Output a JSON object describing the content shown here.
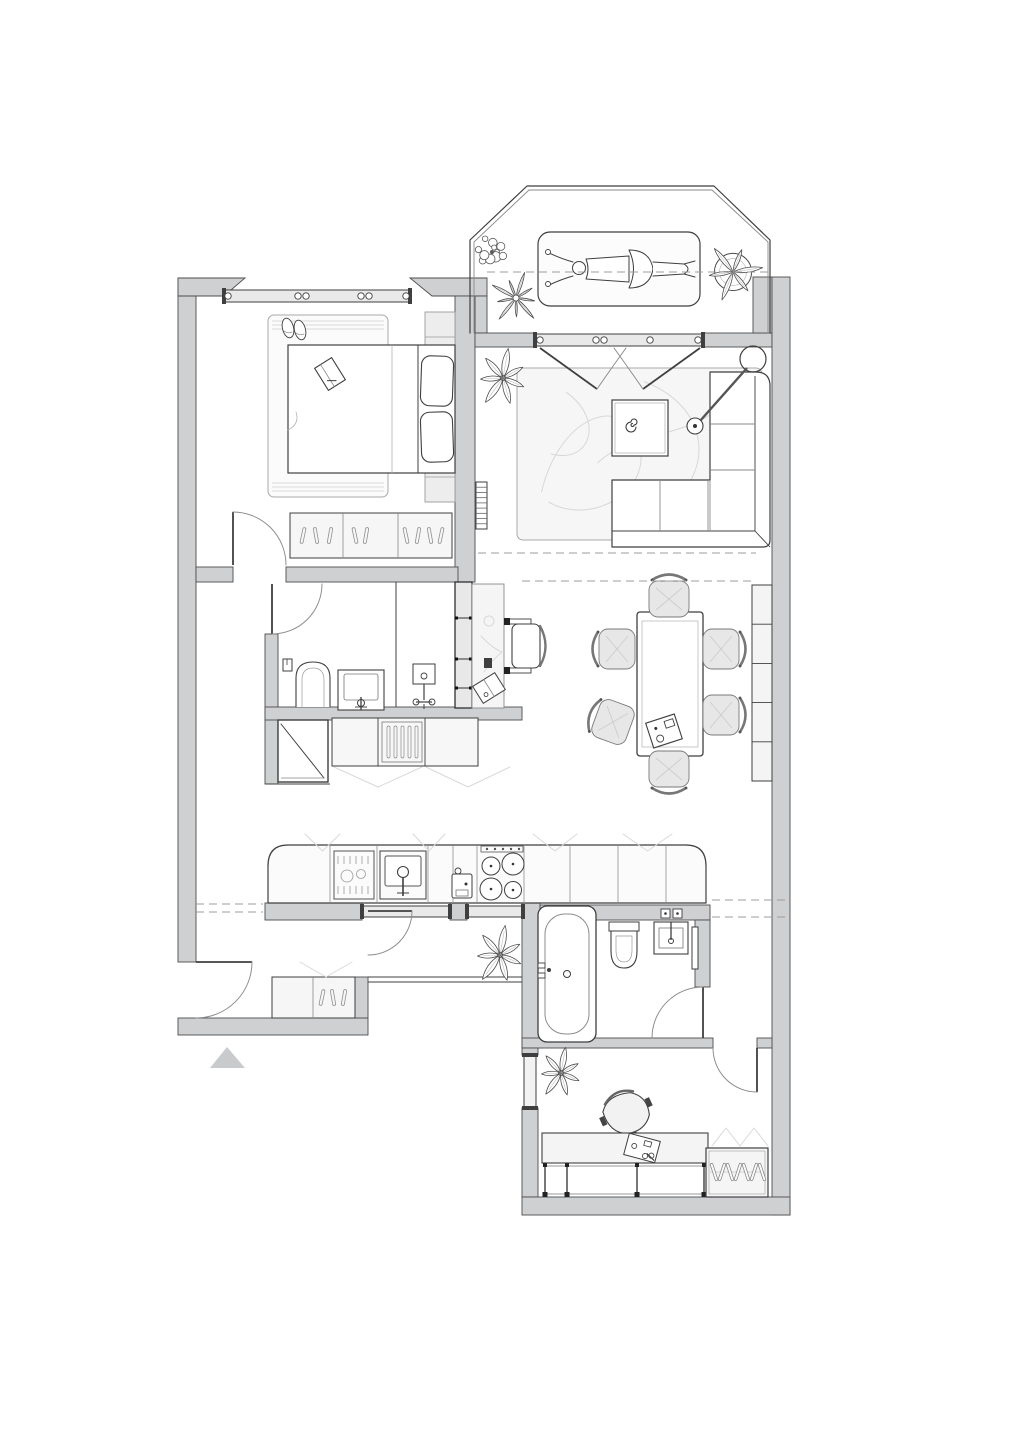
{
  "meta": {
    "title": "Apartment floor plan, top view, furnished"
  },
  "canvas": {
    "width": 1018,
    "height": 1440,
    "background": "#ffffff"
  },
  "palette": {
    "wall_fill": "#cfd0d2",
    "wall_stroke": "#4d4d4d",
    "line": "#3f3f3f",
    "line_mid": "#8a8a8a",
    "ghost": "#d9d9d9",
    "dash": "#9c9c9c",
    "light": "#f3f3f4",
    "chair_fill": "#e7e7e8",
    "marker_fill": "#c9cacc",
    "rug_line": "#d8d8d8"
  },
  "rooms": [
    {
      "name": "balcony",
      "items": [
        "sun-lounger",
        "plants",
        "railing"
      ]
    },
    {
      "name": "bedroom",
      "items": [
        "double-bed",
        "rug",
        "slippers",
        "book",
        "headboard-panel",
        "sideboard",
        "window"
      ]
    },
    {
      "name": "living-room",
      "items": [
        "rug",
        "coffee-table",
        "corner-sofa",
        "arc-floor-lamp",
        "radiator",
        "plant",
        "balcony-doors"
      ]
    },
    {
      "name": "dining-area",
      "items": [
        "dining-table",
        "six-chairs",
        "shelf-unit",
        "serving-tray"
      ]
    },
    {
      "name": "bathroom",
      "items": [
        "toilet",
        "washbasin",
        "shower-mixer",
        "partition"
      ]
    },
    {
      "name": "hall-closet",
      "items": [
        "mirror-panel",
        "drawer-unit",
        "folding-doors"
      ]
    },
    {
      "name": "workspace-nook",
      "items": [
        "desk",
        "chair",
        "notebook",
        "storage-wall"
      ]
    },
    {
      "name": "kitchen",
      "items": [
        "counter",
        "dishwasher",
        "sink",
        "cooktop",
        "coffee-machine",
        "plant",
        "glazed-partition-door"
      ]
    },
    {
      "name": "hallway",
      "items": [
        "shoe-cabinet",
        "entry-door",
        "entrance-marker"
      ]
    },
    {
      "name": "bathroom-2",
      "items": [
        "bathtub",
        "toilet",
        "washbasin",
        "towel-rail"
      ]
    },
    {
      "name": "office",
      "items": [
        "desk",
        "office-chair",
        "wardrobe",
        "plant",
        "window"
      ]
    }
  ],
  "plan": {
    "railing": {
      "name": "balcony-railing",
      "outer": "M 470,333 L 470,240 L 527,186 L 714,186 L 770,240 L 770,333",
      "inner": "M 474,333 L 474,242 L 529,190 L 712,190 L 768,242 L 768,333"
    },
    "walls": [
      {
        "name": "outer-left-wall",
        "rect": [
          178,
          278,
          18,
          684
        ]
      },
      {
        "name": "hall-south-wall",
        "rect": [
          178,
          1018,
          190,
          17
        ]
      },
      {
        "name": "bedroom-north-wall-left",
        "poly": [
          [
            178,
            278
          ],
          [
            245,
            278
          ],
          [
            224,
            296
          ],
          [
            178,
            296
          ]
        ]
      },
      {
        "name": "bedroom-north-wall-right",
        "poly": [
          [
            410,
            278
          ],
          [
            487,
            278
          ],
          [
            487,
            296
          ],
          [
            432,
            296
          ]
        ]
      },
      {
        "name": "balcony-west-jamb",
        "rect": [
          475,
          296,
          12,
          37
        ]
      },
      {
        "name": "bedroom-living-divider-wall",
        "rect": [
          455,
          296,
          20,
          286
        ]
      },
      {
        "name": "bedroom-south-wall-left",
        "rect": [
          196,
          567,
          37,
          15
        ]
      },
      {
        "name": "bedroom-south-wall-right",
        "rect": [
          286,
          567,
          172,
          15
        ]
      },
      {
        "name": "bathroom-west-wall",
        "rect": [
          265,
          634,
          13,
          78
        ]
      },
      {
        "name": "closet-west-wall",
        "rect": [
          265,
          712,
          13,
          72
        ]
      },
      {
        "name": "bathroom-south-wall",
        "rect": [
          265,
          707,
          257,
          13
        ]
      },
      {
        "name": "balcony-wall-left",
        "rect": [
          475,
          333,
          60,
          14
        ]
      },
      {
        "name": "balcony-wall-right",
        "rect": [
          703,
          333,
          69,
          14
        ]
      },
      {
        "name": "balcony-east-wall",
        "rect": [
          753,
          277,
          19,
          56
        ]
      },
      {
        "name": "outer-right-wall",
        "rect": [
          772,
          277,
          18,
          938
        ]
      },
      {
        "name": "kitchen-back-wall-a",
        "rect": [
          265,
          903,
          97,
          17
        ]
      },
      {
        "name": "kitchen-back-wall-b",
        "rect": [
          450,
          903,
          17,
          17
        ]
      },
      {
        "name": "bathroom2-west-wall",
        "rect": [
          522,
          903,
          18,
          145
        ]
      },
      {
        "name": "bathroom2-north-wall",
        "rect": [
          540,
          905,
          170,
          15
        ]
      },
      {
        "name": "bathroom2-east-wall",
        "rect": [
          695,
          920,
          15,
          67
        ]
      },
      {
        "name": "office-north-wall",
        "rect": [
          522,
          1038,
          191,
          10
        ]
      },
      {
        "name": "office-north-wall-stub",
        "rect": [
          757,
          1038,
          15,
          10
        ]
      },
      {
        "name": "office-west-wall-a",
        "rect": [
          522,
          1048,
          16,
          7
        ]
      },
      {
        "name": "office-west-wall-b",
        "rect": [
          522,
          1108,
          16,
          89
        ]
      },
      {
        "name": "office-south-wall",
        "rect": [
          522,
          1197,
          268,
          18
        ]
      },
      {
        "name": "hall-parapet-post",
        "rect": [
          355,
          977,
          13,
          41
        ]
      }
    ],
    "windows": [
      {
        "name": "bedroom-window",
        "band": [
          224,
          290,
          186,
          12
        ],
        "mullions": [
          228,
          298,
          306,
          361,
          369,
          406
        ]
      },
      {
        "name": "balcony-door-glazing",
        "band": [
          535,
          334,
          168,
          12
        ],
        "mullions": [
          540,
          596,
          604,
          650,
          698
        ]
      },
      {
        "name": "kitchen-window-a",
        "band": [
          362,
          906,
          88,
          11
        ],
        "mullions": []
      },
      {
        "name": "kitchen-window-b",
        "band": [
          467,
          906,
          56,
          11
        ],
        "mullions": []
      },
      {
        "name": "office-window",
        "vband": [
          524,
          1055,
          12,
          53
        ]
      }
    ],
    "thin_lines": [
      {
        "name": "hall-parapet-a",
        "line": [
          368,
          977,
          522,
          977
        ]
      },
      {
        "name": "hall-parapet-b",
        "line": [
          368,
          982,
          522,
          982
        ]
      },
      {
        "name": "bathroom-partition",
        "line": [
          396,
          582,
          396,
          707
        ]
      },
      {
        "name": "closet-base",
        "line": [
          265,
          784,
          330,
          784
        ]
      }
    ],
    "doors": [
      {
        "name": "bedroom-door",
        "leaf": [
          233,
          565,
          233,
          512
        ],
        "arc": "M 233,512 A 53 53 0 0 1 286,565"
      },
      {
        "name": "bathroom-door",
        "leaf": [
          272,
          584,
          272,
          634
        ],
        "arc": "M 272,634 A 50 50 0 0 0 322,584"
      },
      {
        "name": "entry-door",
        "leaf": [
          196,
          962,
          252,
          962
        ],
        "arc": "M 252,962 A 56 56 0 0 1 196,1018"
      },
      {
        "name": "kitchen-glass-door",
        "leaf": [
          368,
          911,
          412,
          911
        ],
        "arc": "M 412,911 A 44 44 0 0 1 368,955"
      },
      {
        "name": "bathroom2-door",
        "leaf": [
          703,
          987,
          703,
          1038
        ],
        "arc": "M 703,987 A 51 51 0 0 0 652,1038"
      },
      {
        "name": "office-door",
        "leaf": [
          757,
          1048,
          757,
          1092
        ],
        "arc": "M 713,1048 A 44 44 0 0 0 757,1092"
      },
      {
        "name": "balcony-door-left",
        "leaf": [
          540,
          348,
          597,
          389
        ],
        "arc": "M 597,389 Q 613,366 626,348"
      },
      {
        "name": "balcony-door-right",
        "leaf": [
          700,
          348,
          643,
          389
        ],
        "arc": "M 643,389 Q 627,366 614,348"
      }
    ],
    "dashes": [
      {
        "name": "roof-line-balcony",
        "line": [
          487,
          272,
          768,
          272
        ]
      },
      {
        "name": "roof-line-living",
        "line": [
          478,
          553,
          756,
          553
        ]
      },
      {
        "name": "roof-line-dining",
        "line": [
          522,
          581,
          756,
          581
        ]
      },
      {
        "name": "roof-line-hall-a",
        "line": [
          196,
          904,
          263,
          904
        ]
      },
      {
        "name": "roof-line-hall-b",
        "line": [
          196,
          912,
          263,
          912
        ]
      },
      {
        "name": "roof-line-east-a",
        "line": [
          712,
          900,
          790,
          900
        ]
      },
      {
        "name": "roof-line-east-b",
        "line": [
          712,
          917,
          790,
          917
        ]
      }
    ],
    "furniture": [
      {
        "name": "living-rug",
        "type": "rug",
        "rect": [
          517,
          368,
          245,
          172
        ],
        "swirls": true
      },
      {
        "name": "bedroom-rug",
        "type": "rug",
        "rect": [
          268,
          315,
          120,
          182
        ],
        "fringe": true
      },
      {
        "name": "headboard-panel",
        "type": "panel",
        "rect": [
          425,
          312,
          30,
          190
        ],
        "divs": [
          337,
          477
        ]
      },
      {
        "name": "double-bed",
        "type": "bed",
        "rect": [
          288,
          345,
          167,
          128
        ]
      },
      {
        "name": "slippers",
        "type": "slippers",
        "at": [
          292,
          328
        ]
      },
      {
        "name": "book-on-bed",
        "type": "book",
        "at": [
          330,
          374
        ],
        "rot": -32
      },
      {
        "name": "bedroom-sideboard",
        "type": "sideboard",
        "rect": [
          290,
          513,
          162,
          45
        ],
        "divs": [
          343,
          398
        ],
        "ticks": [
          [
            303,
            12
          ],
          [
            316,
            -10
          ],
          [
            330,
            10
          ],
          [
            355,
            -12
          ],
          [
            366,
            10
          ],
          [
            406,
            -12
          ],
          [
            418,
            10
          ],
          [
            430,
            -10
          ],
          [
            441,
            12
          ]
        ]
      },
      {
        "name": "corner-sofa",
        "type": "sofa",
        "rect": [
          612,
          372,
          158,
          175
        ]
      },
      {
        "name": "coffee-table",
        "type": "coffee-table",
        "rect": [
          612,
          400,
          56,
          56
        ]
      },
      {
        "name": "arc-lamp",
        "type": "arc-lamp",
        "base": [
          753,
          359
        ],
        "head": [
          695,
          426
        ]
      },
      {
        "name": "living-radiator",
        "type": "radiator",
        "rect": [
          476,
          482,
          11,
          47
        ]
      },
      {
        "name": "dining-table",
        "type": "dining-table",
        "rect": [
          637,
          612,
          66,
          144
        ]
      },
      {
        "name": "dining-chair-north",
        "type": "chair",
        "at": [
          669,
          599
        ],
        "rot": 0
      },
      {
        "name": "dining-chair-west-1",
        "type": "chair",
        "at": [
          617,
          649
        ],
        "rot": -90
      },
      {
        "name": "dining-chair-east-1",
        "type": "chair",
        "at": [
          721,
          649
        ],
        "rot": 90
      },
      {
        "name": "dining-chair-west-2",
        "type": "chair",
        "at": [
          613,
          722
        ],
        "rot": -70
      },
      {
        "name": "dining-chair-east-2",
        "type": "chair",
        "at": [
          721,
          715
        ],
        "rot": 90
      },
      {
        "name": "dining-chair-south",
        "type": "chair",
        "at": [
          669,
          769
        ],
        "rot": 180
      },
      {
        "name": "dining-shelf",
        "type": "shelf",
        "rect": [
          752,
          585,
          20,
          196
        ],
        "cells": 5
      },
      {
        "name": "nook-storage-wall",
        "type": "storage-band",
        "rect": [
          455,
          582,
          17,
          126
        ],
        "divs": [
          618,
          659,
          688
        ]
      },
      {
        "name": "nook-desk",
        "type": "desk-v",
        "rect": [
          472,
          584,
          32,
          124
        ]
      },
      {
        "name": "nook-chair",
        "type": "chair-side",
        "at": [
          526,
          646
        ]
      },
      {
        "name": "toilet",
        "type": "toilet-up",
        "at": [
          296,
          660
        ]
      },
      {
        "name": "washbasin",
        "type": "sink-up",
        "rect": [
          338,
          670,
          46,
          40
        ]
      },
      {
        "name": "shower-mixer",
        "type": "mixer",
        "at": [
          413,
          664
        ]
      },
      {
        "name": "closet-mirror",
        "type": "mirror",
        "rect": [
          278,
          720,
          50,
          62
        ]
      },
      {
        "name": "closet-cabinets",
        "type": "closet-row",
        "rect": [
          332,
          718,
          146,
          48
        ],
        "divs": [
          378,
          425
        ]
      },
      {
        "name": "kitchen-counter",
        "type": "kitchen",
        "rect": [
          268,
          845,
          438,
          58
        ]
      },
      {
        "name": "shoe-cabinet",
        "type": "sideboard",
        "rect": [
          272,
          977,
          83,
          41
        ],
        "divs": [
          313
        ],
        "ticks": [
          [
            322,
            12
          ],
          [
            333,
            -10
          ],
          [
            344,
            10
          ]
        ],
        "vs": true
      },
      {
        "name": "entrance-marker",
        "type": "marker",
        "poly": [
          [
            210,
            1068
          ],
          [
            245,
            1068
          ],
          [
            227,
            1047
          ]
        ]
      },
      {
        "name": "bathtub",
        "type": "bathtub",
        "rect": [
          538,
          906,
          58,
          136
        ]
      },
      {
        "name": "toilet-2",
        "type": "toilet-down",
        "at": [
          609,
          922
        ]
      },
      {
        "name": "washbasin-2",
        "type": "sink-down",
        "rect": [
          654,
          922,
          34,
          32
        ]
      },
      {
        "name": "towel-rail",
        "type": "rail",
        "rect": [
          692,
          927,
          6,
          42
        ]
      },
      {
        "name": "office-chair",
        "type": "office-chair",
        "at": [
          627,
          1114
        ],
        "rot": -25
      },
      {
        "name": "office-desk",
        "type": "desk-h",
        "rect": [
          542,
          1133,
          166,
          30
        ]
      },
      {
        "name": "office-wardrobe",
        "type": "wardrobe",
        "rect": [
          706,
          1148,
          62,
          49
        ]
      },
      {
        "name": "sun-lounger",
        "type": "lounger",
        "rect": [
          538,
          232,
          162,
          74
        ]
      }
    ],
    "plants": [
      {
        "name": "plant-balcony-flowers",
        "type": "plant-cluster",
        "at": [
          492,
          252
        ],
        "r": 20
      },
      {
        "name": "plant-balcony-star",
        "type": "plant-star",
        "at": [
          516,
          298
        ],
        "r": 27
      },
      {
        "name": "plant-balcony-basket",
        "type": "plant-basket",
        "at": [
          733,
          272
        ],
        "r": 30
      },
      {
        "name": "plant-living",
        "type": "plant-leafy",
        "at": [
          503,
          378
        ],
        "r": 30
      },
      {
        "name": "plant-kitchen",
        "type": "plant-leafy",
        "at": [
          500,
          955
        ],
        "r": 30
      },
      {
        "name": "plant-office",
        "type": "plant-leafy",
        "at": [
          561,
          1073
        ],
        "r": 26
      }
    ]
  }
}
